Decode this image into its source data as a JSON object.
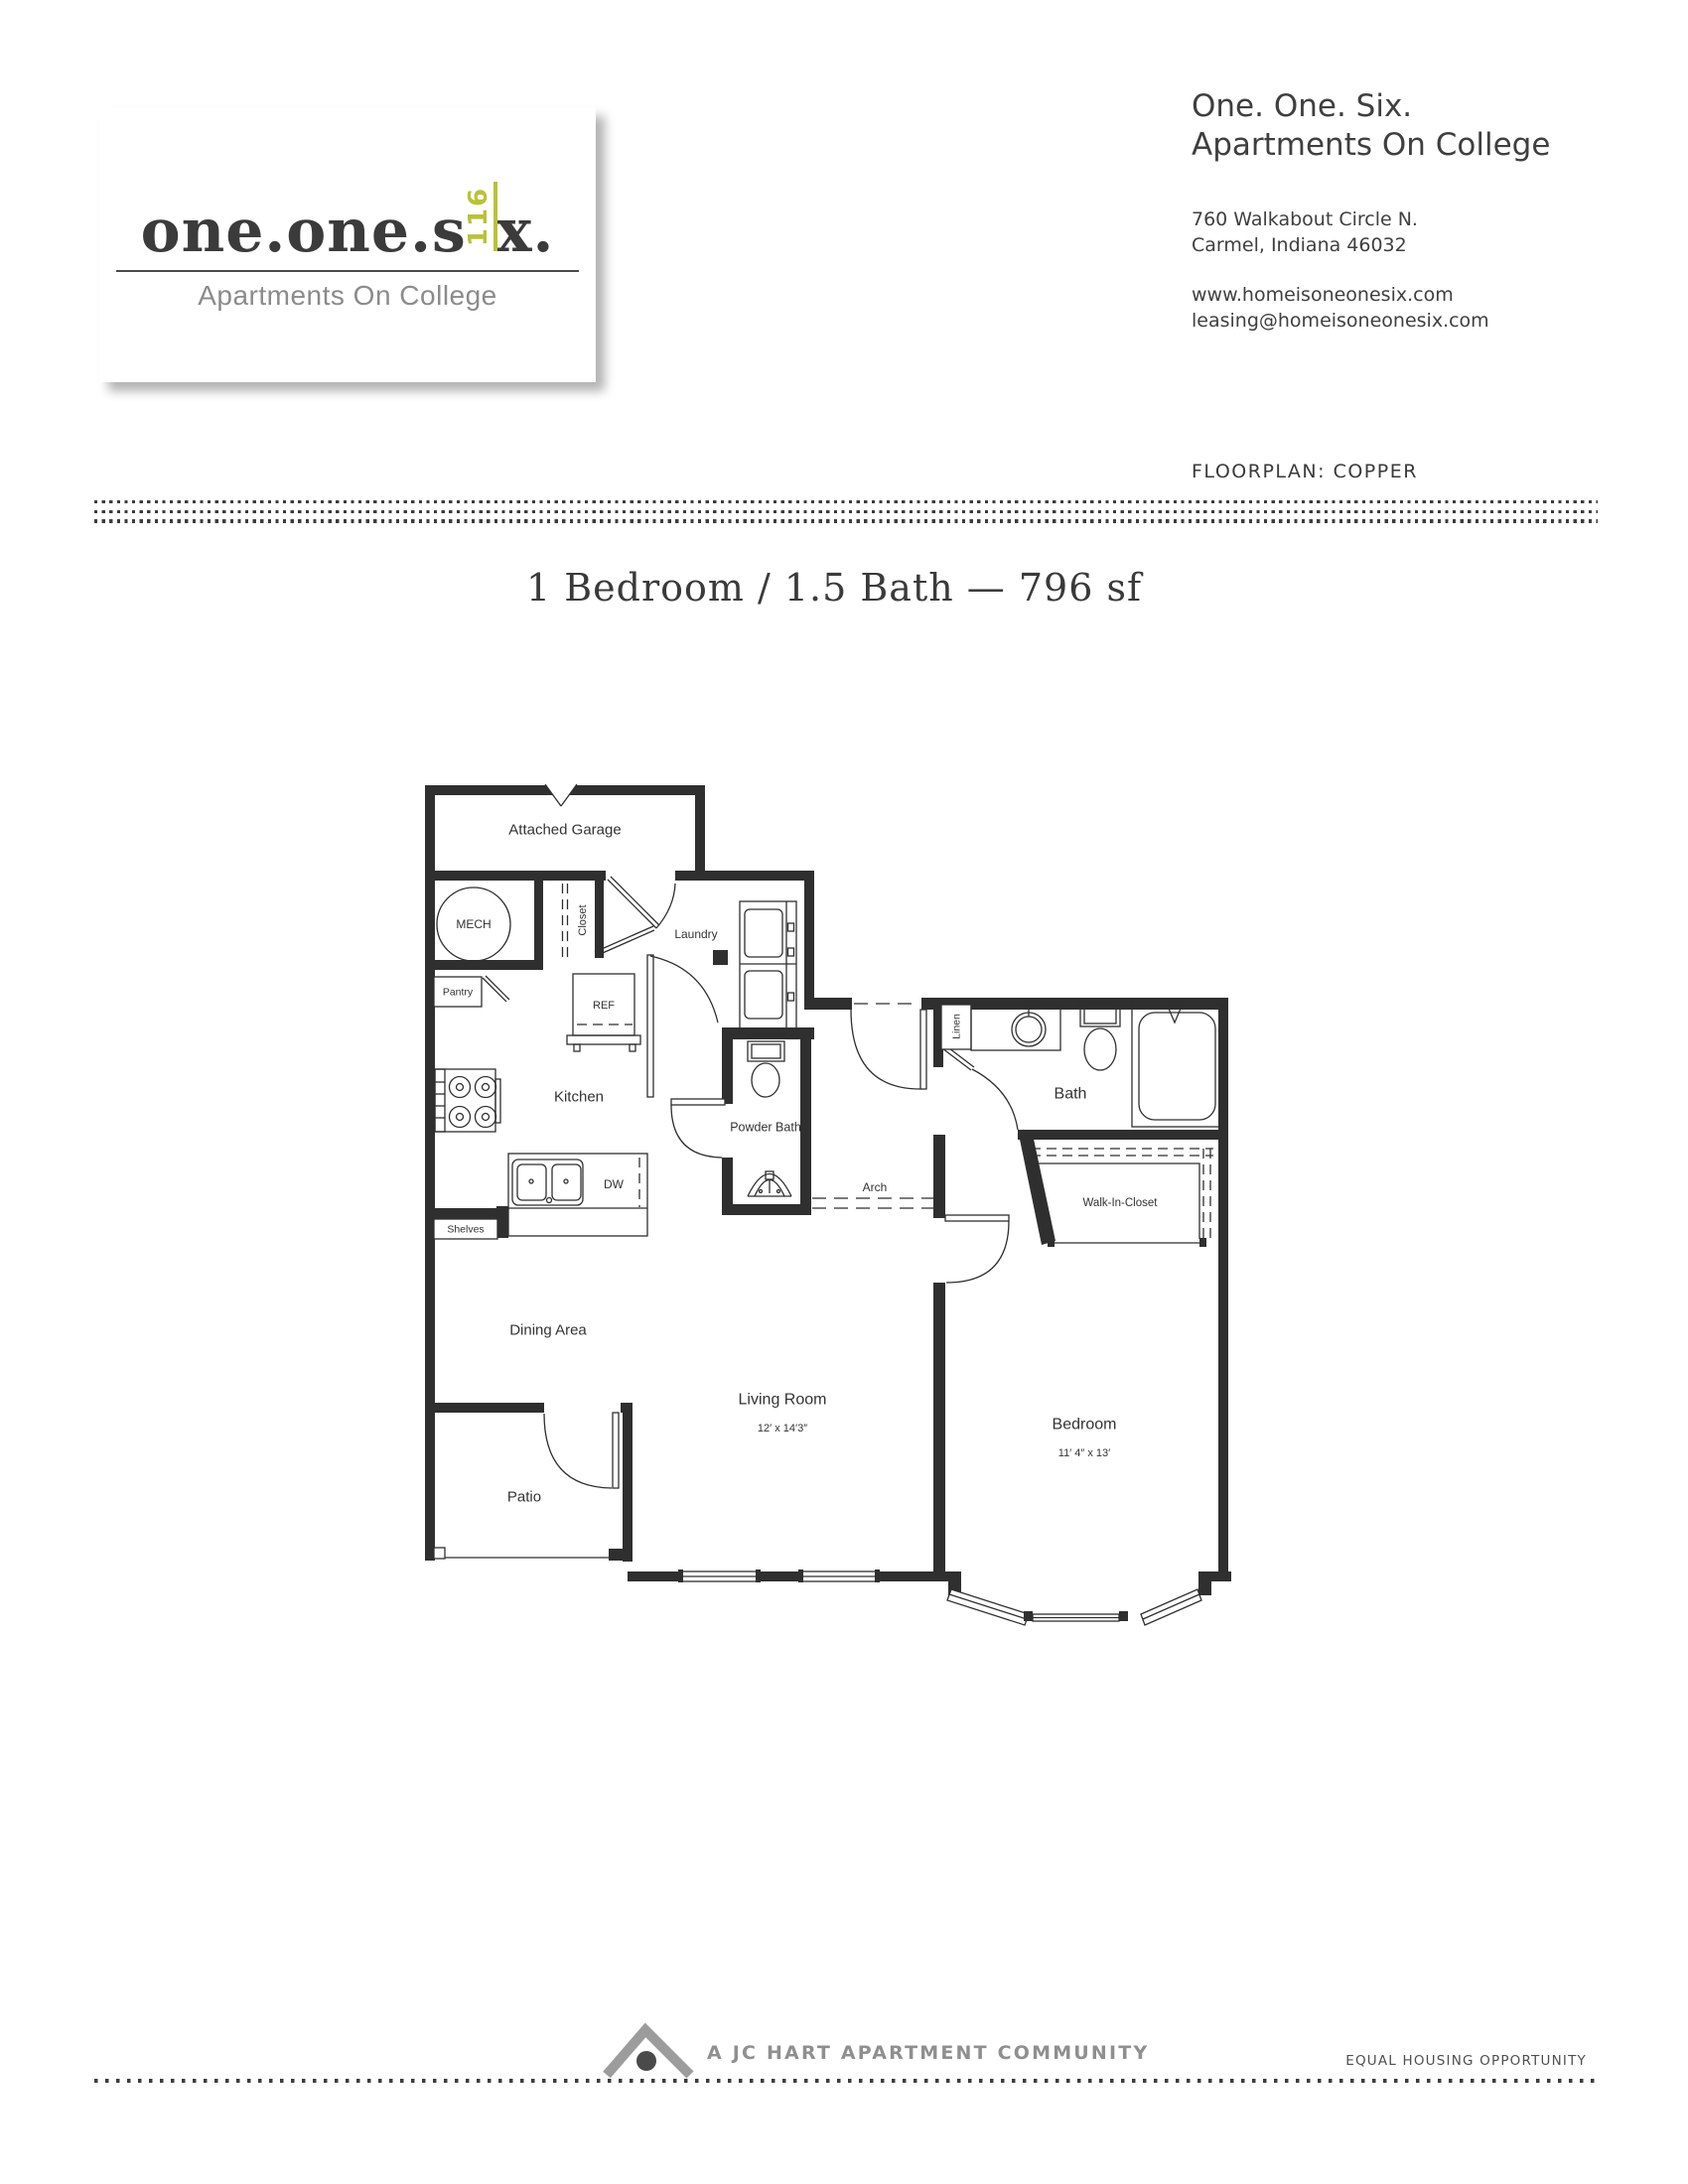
{
  "header": {
    "logo": {
      "word_start": "one.one.s",
      "rotated_number": "116",
      "word_end": "x.",
      "tagline": "Apartments On College"
    },
    "contact": {
      "name_line1": "One. One. Six.",
      "name_line2": "Apartments On College",
      "address_line1": "760 Walkabout Circle N.",
      "address_line2": "Carmel, Indiana 46032",
      "website": "www.homeisoneonesix.com",
      "email": "leasing@homeisoneonesix.com"
    },
    "floorplan_label": "FLOORPLAN: COPPER"
  },
  "title": "1 Bedroom / 1.5 Bath — 796 sf",
  "floorplan": {
    "rooms": {
      "attached_garage": "Attached Garage",
      "mech": "MECH",
      "closet": "Closet",
      "laundry": "Laundry",
      "pantry": "Pantry",
      "ref": "REF",
      "kitchen": "Kitchen",
      "powder_bath": "Powder Bath",
      "shelves": "Shelves",
      "dishwasher": "DW",
      "dining_area": "Dining Area",
      "living_room": "Living Room",
      "patio": "Patio",
      "bedroom": "Bedroom",
      "bath": "Bath",
      "linen": "Linen",
      "arch": "Arch",
      "walk_in_closet": "Walk-In-Closet"
    },
    "dimensions": {
      "living_room": "12′ x 14′3″",
      "bedroom": "11′ 4″ x 13′"
    }
  },
  "footer": {
    "community": "A JC HART APARTMENT COMMUNITY",
    "equal_housing": "EQUAL HOUSING OPPORTUNITY"
  },
  "colors": {
    "accent_olive": "#b9c238",
    "ink": "#3a3a3a",
    "plan_line": "#2f2f2f",
    "muted_gray": "#8f8f8f"
  }
}
